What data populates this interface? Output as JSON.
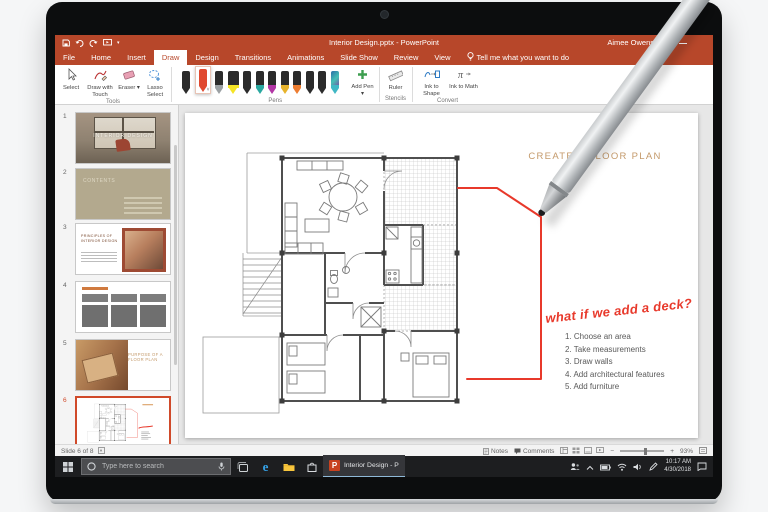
{
  "window": {
    "title": "Interior Design.pptx - PowerPoint",
    "user": "Aimee Owens"
  },
  "tabs": {
    "items": [
      {
        "label": "File"
      },
      {
        "label": "Home"
      },
      {
        "label": "Insert"
      },
      {
        "label": "Draw"
      },
      {
        "label": "Design"
      },
      {
        "label": "Transitions"
      },
      {
        "label": "Animations"
      },
      {
        "label": "Slide Show"
      },
      {
        "label": "Review"
      },
      {
        "label": "View"
      }
    ],
    "tell_me": "Tell me what you want to do"
  },
  "ribbon": {
    "tools": {
      "label": "Tools",
      "select": "Select",
      "draw_with_touch": "Draw with Touch",
      "eraser": "Eraser",
      "lasso": "Lasso Select"
    },
    "pens": {
      "label": "Pens",
      "items": [
        {
          "name": "black-pen",
          "color": "#2b2b2b"
        },
        {
          "name": "red-pen",
          "color": "#E0492F"
        },
        {
          "name": "silver-pen",
          "color": "#9BA0A3"
        },
        {
          "name": "yellow-highlighter",
          "color": "#F5E425"
        },
        {
          "name": "black-pen",
          "color": "#2b2b2b"
        },
        {
          "name": "teal-pen",
          "color": "#2AA8A0"
        },
        {
          "name": "magenta-pen",
          "color": "#B236A5"
        },
        {
          "name": "gold-pen",
          "color": "#E7B32C"
        },
        {
          "name": "orange-pen",
          "color": "#ED7D31"
        },
        {
          "name": "black-pen",
          "color": "#2b2b2b"
        },
        {
          "name": "black-pen",
          "color": "#2b2b2b"
        },
        {
          "name": "galaxy-pen",
          "color": "#3FB7C4"
        }
      ],
      "add_pen": "Add Pen"
    },
    "stencils": {
      "label": "Stencils",
      "ruler": "Ruler"
    },
    "convert": {
      "label": "Convert",
      "ink_to_shape": "Ink to Shape",
      "ink_to_math": "Ink to Math"
    }
  },
  "thumbnails": {
    "items": [
      {
        "num": "1",
        "title": "INTERIOR DESIGN"
      },
      {
        "num": "2",
        "title": "CONTENTS"
      },
      {
        "num": "3",
        "title": "PRINCIPLES OF INTERIOR DESIGN"
      },
      {
        "num": "4",
        "title": ""
      },
      {
        "num": "5",
        "title": "PURPOSE OF A FLOOR PLAN"
      },
      {
        "num": "6",
        "title": ""
      }
    ]
  },
  "slide": {
    "title": "CREATE A FLOOR PLAN",
    "ink_note": "what if we add a deck?",
    "steps": [
      {
        "text": "1. Choose an area"
      },
      {
        "text": "2. Take measurements"
      },
      {
        "text": "3. Draw walls"
      },
      {
        "text": "4. Add architectural features"
      },
      {
        "text": "5. Add furniture"
      }
    ]
  },
  "statusbar": {
    "slide_info": "Slide 6 of 8",
    "notes": "Notes",
    "comments": "Comments",
    "zoom_level": "93%"
  },
  "taskbar": {
    "search_placeholder": "Type here to search",
    "app_label": "Interior Design - P",
    "time": "10:17 AM",
    "date": "4/30/2018"
  },
  "colors": {
    "accent": "#B7472A",
    "ink": "#E8392B",
    "slide_title": "#C49A6B",
    "thumb_selected": "#D04A2A"
  }
}
